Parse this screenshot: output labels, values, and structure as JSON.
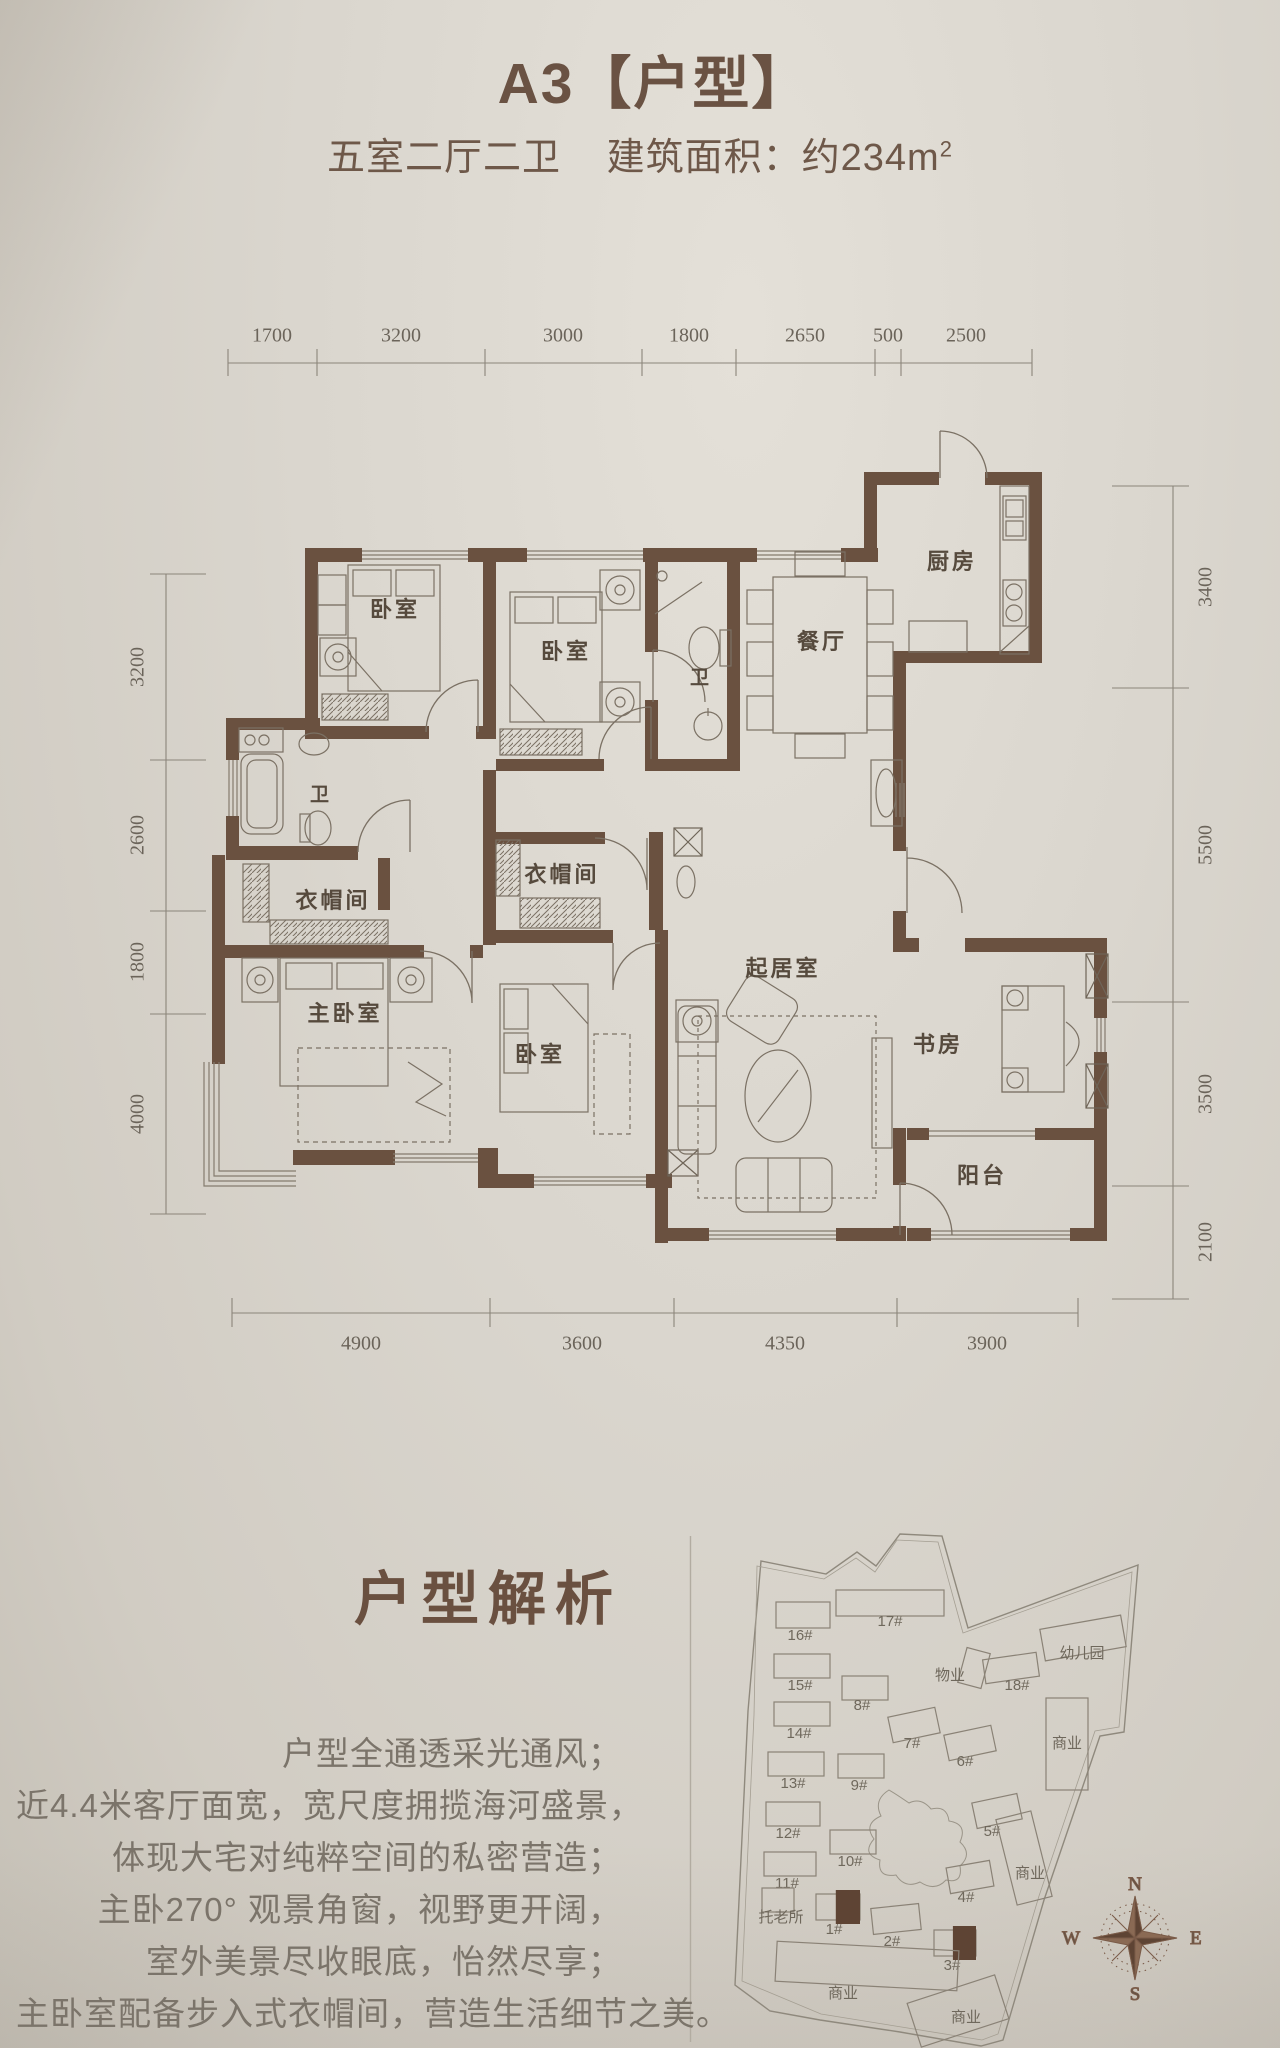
{
  "header": {
    "title": "A3【户型】",
    "subtitle_rooms": "五室二厅二卫",
    "subtitle_area": "建筑面积：约234m",
    "subtitle_area_sup": "2"
  },
  "floor_plan": {
    "rooms": [
      {
        "label": "卧室",
        "x": 395,
        "y": 608
      },
      {
        "label": "卧室",
        "x": 566,
        "y": 650
      },
      {
        "label": "卫",
        "x": 700,
        "y": 676,
        "small": true
      },
      {
        "label": "餐厅",
        "x": 822,
        "y": 640
      },
      {
        "label": "厨房",
        "x": 952,
        "y": 560
      },
      {
        "label": "卫",
        "x": 320,
        "y": 793,
        "small": true
      },
      {
        "label": "衣帽间",
        "x": 333,
        "y": 899
      },
      {
        "label": "衣帽间",
        "x": 562,
        "y": 873
      },
      {
        "label": "主卧室",
        "x": 345,
        "y": 1012
      },
      {
        "label": "卧室",
        "x": 540,
        "y": 1053
      },
      {
        "label": "起居室",
        "x": 783,
        "y": 967
      },
      {
        "label": "书房",
        "x": 938,
        "y": 1043
      },
      {
        "label": "阳台",
        "x": 982,
        "y": 1174
      }
    ],
    "dimensions": {
      "top": {
        "line_y": 363,
        "x1": 228,
        "x2": 1032,
        "label_y": 336,
        "ticks": [
          228,
          317,
          485,
          642,
          736,
          875,
          901,
          1032
        ],
        "labels": [
          {
            "t": "1700",
            "x": 272
          },
          {
            "t": "3200",
            "x": 401
          },
          {
            "t": "3000",
            "x": 563
          },
          {
            "t": "1800",
            "x": 689
          },
          {
            "t": "2650",
            "x": 805
          },
          {
            "t": "500",
            "x": 888
          },
          {
            "t": "2500",
            "x": 966
          }
        ]
      },
      "bottom": {
        "line_y": 1313,
        "x1": 232,
        "x2": 1078,
        "label_y": 1344,
        "ticks": [
          232,
          490,
          674,
          897,
          1078
        ],
        "labels": [
          {
            "t": "4900",
            "x": 361
          },
          {
            "t": "3600",
            "x": 582
          },
          {
            "t": "4350",
            "x": 785
          },
          {
            "t": "3900",
            "x": 987
          }
        ]
      },
      "left": {
        "line_x": 166,
        "y1": 574,
        "y2": 1214,
        "label_x": 138,
        "ticks": [
          574,
          760,
          911,
          1014,
          1214
        ],
        "labels": [
          {
            "t": "3200",
            "y": 667
          },
          {
            "t": "2600",
            "y": 835
          },
          {
            "t": "1800",
            "y": 962
          },
          {
            "t": "4000",
            "y": 1114
          }
        ]
      },
      "right": {
        "line_x": 1173,
        "y1": 486,
        "y2": 1299,
        "label_x": 1206,
        "ticks": [
          486,
          688,
          1002,
          1186,
          1299
        ],
        "labels": [
          {
            "t": "3400",
            "y": 587
          },
          {
            "t": "5500",
            "y": 845
          },
          {
            "t": "3500",
            "y": 1094
          },
          {
            "t": "2100",
            "y": 1242
          }
        ]
      }
    }
  },
  "analysis": {
    "title": "户型解析",
    "lines": [
      "户型全通透采光通风；",
      "近4.4米客厅面宽，宽尺度拥揽海河盛景，",
      "体现大宅对纯粹空间的私密营造；",
      "主卧270° 观景角窗，视野更开阔，",
      "室外美景尽收眼底，怡然尽享；",
      "主卧室配备步入式衣帽间，营造生活细节之美。"
    ]
  },
  "site_map": {
    "buildings": [
      {
        "label": "16#",
        "x": 776,
        "y": 1602,
        "w": 54,
        "h": 26,
        "rot": 0,
        "lx": 800,
        "ly": 1640
      },
      {
        "label": "17#",
        "x": 836,
        "y": 1590,
        "w": 108,
        "h": 26,
        "rot": 0,
        "lx": 890,
        "ly": 1626
      },
      {
        "label": "15#",
        "x": 774,
        "y": 1654,
        "w": 56,
        "h": 24,
        "rot": 0,
        "lx": 800,
        "ly": 1690
      },
      {
        "label": "8#",
        "x": 842,
        "y": 1676,
        "w": 46,
        "h": 24,
        "rot": 0,
        "lx": 862,
        "ly": 1710
      },
      {
        "label": "物业",
        "x": 962,
        "y": 1650,
        "w": 24,
        "h": 36,
        "rot": 15,
        "lx": 950,
        "ly": 1680
      },
      {
        "label": "18#",
        "x": 984,
        "y": 1656,
        "w": 54,
        "h": 24,
        "rot": -8,
        "lx": 1017,
        "ly": 1690
      },
      {
        "label": "幼儿园",
        "x": 1042,
        "y": 1622,
        "w": 82,
        "h": 32,
        "rot": -10,
        "lx": 1082,
        "ly": 1658
      },
      {
        "label": "14#",
        "x": 774,
        "y": 1702,
        "w": 56,
        "h": 24,
        "rot": 0,
        "lx": 799,
        "ly": 1738
      },
      {
        "label": "7#",
        "x": 890,
        "y": 1712,
        "w": 48,
        "h": 26,
        "rot": -12,
        "lx": 912,
        "ly": 1748
      },
      {
        "label": "6#",
        "x": 946,
        "y": 1730,
        "w": 48,
        "h": 26,
        "rot": -12,
        "lx": 965,
        "ly": 1766
      },
      {
        "label": "商业",
        "x": 1046,
        "y": 1698,
        "w": 42,
        "h": 92,
        "rot": 0,
        "lx": 1067,
        "ly": 1748
      },
      {
        "label": "13#",
        "x": 768,
        "y": 1752,
        "w": 56,
        "h": 24,
        "rot": 0,
        "lx": 793,
        "ly": 1788
      },
      {
        "label": "9#",
        "x": 838,
        "y": 1754,
        "w": 46,
        "h": 24,
        "rot": 0,
        "lx": 859,
        "ly": 1790
      },
      {
        "label": "12#",
        "x": 766,
        "y": 1802,
        "w": 54,
        "h": 24,
        "rot": 0,
        "lx": 788,
        "ly": 1838
      },
      {
        "label": "5#",
        "x": 974,
        "y": 1798,
        "w": 46,
        "h": 26,
        "rot": -12,
        "lx": 992,
        "ly": 1836
      },
      {
        "label": "10#",
        "x": 830,
        "y": 1830,
        "w": 46,
        "h": 24,
        "rot": 0,
        "lx": 850,
        "ly": 1866
      },
      {
        "label": "商业",
        "x": 1006,
        "y": 1814,
        "w": 36,
        "h": 88,
        "rot": -14,
        "lx": 1030,
        "ly": 1878
      },
      {
        "label": "11#",
        "x": 764,
        "y": 1852,
        "w": 52,
        "h": 24,
        "rot": 0,
        "lx": 787,
        "ly": 1888
      },
      {
        "label": "托老所",
        "x": 762,
        "y": 1888,
        "w": 32,
        "h": 24,
        "rot": 0,
        "lx": 781,
        "ly": 1922
      },
      {
        "label": "1#",
        "x": 816,
        "y": 1894,
        "w": 44,
        "h": 26,
        "rot": 0,
        "lx": 834,
        "ly": 1934,
        "filled": true
      },
      {
        "label": "2#",
        "x": 872,
        "y": 1906,
        "w": 48,
        "h": 26,
        "rot": -6,
        "lx": 892,
        "ly": 1946
      },
      {
        "label": "3#",
        "x": 934,
        "y": 1930,
        "w": 42,
        "h": 26,
        "rot": 0,
        "lx": 952,
        "ly": 1970,
        "filled": true
      },
      {
        "label": "4#",
        "x": 948,
        "y": 1864,
        "w": 44,
        "h": 26,
        "rot": -10,
        "lx": 966,
        "ly": 1902
      },
      {
        "label": "商业",
        "x": 776,
        "y": 1946,
        "w": 182,
        "h": 40,
        "rot": 3,
        "lx": 843,
        "ly": 1998
      },
      {
        "label": "商业",
        "x": 912,
        "y": 1988,
        "w": 92,
        "h": 46,
        "rot": -18,
        "lx": 966,
        "ly": 2022
      }
    ],
    "compass": {
      "n": "N",
      "e": "E",
      "s": "S",
      "w": "W"
    }
  }
}
